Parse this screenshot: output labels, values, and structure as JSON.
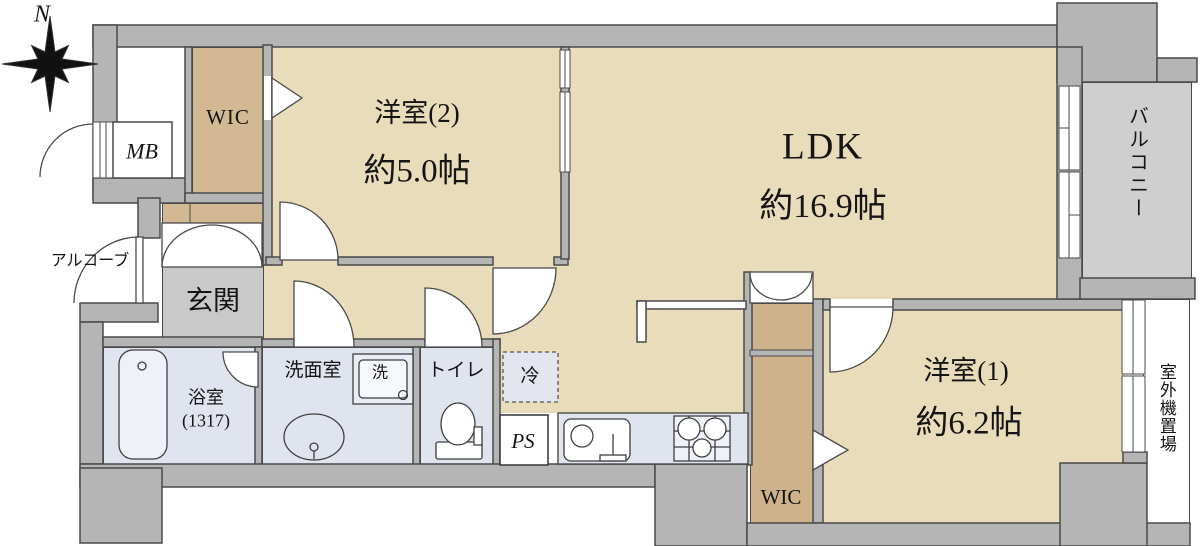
{
  "plan": {
    "compass": {
      "north_label": "N"
    },
    "rooms": {
      "wic_top": {
        "label": "WIC"
      },
      "mb": {
        "label": "MB"
      },
      "yoshitsu2": {
        "name": "洋室(2)",
        "size": "約5.0帖"
      },
      "ldk": {
        "name": "LDK",
        "size": "約16.9帖"
      },
      "balcony": {
        "label": "バルコニー"
      },
      "alcove": {
        "label": "アルコーブ"
      },
      "genkan": {
        "label": "玄関"
      },
      "bath": {
        "name": "浴室",
        "size": "(1317)"
      },
      "washroom": {
        "label": "洗面室"
      },
      "washer": {
        "label": "洗"
      },
      "toilet": {
        "label": "トイレ"
      },
      "fridge": {
        "label": "冷"
      },
      "ps": {
        "label": "PS"
      },
      "wic_bottom": {
        "label": "WIC"
      },
      "yoshitsu1": {
        "name": "洋室(1)",
        "size": "約6.2帖"
      },
      "outdoor_unit": {
        "label": "室外機置場"
      }
    },
    "colors": {
      "wall": "#b5b5b5",
      "line": "#4a4a4a",
      "room_tan": "#e9dcba",
      "closet_tan": "#d2b893",
      "wet_gray": "#e0e4ee",
      "genkan_gray": "#c9c9c9",
      "balcony_gray": "#cfcfcf"
    }
  }
}
